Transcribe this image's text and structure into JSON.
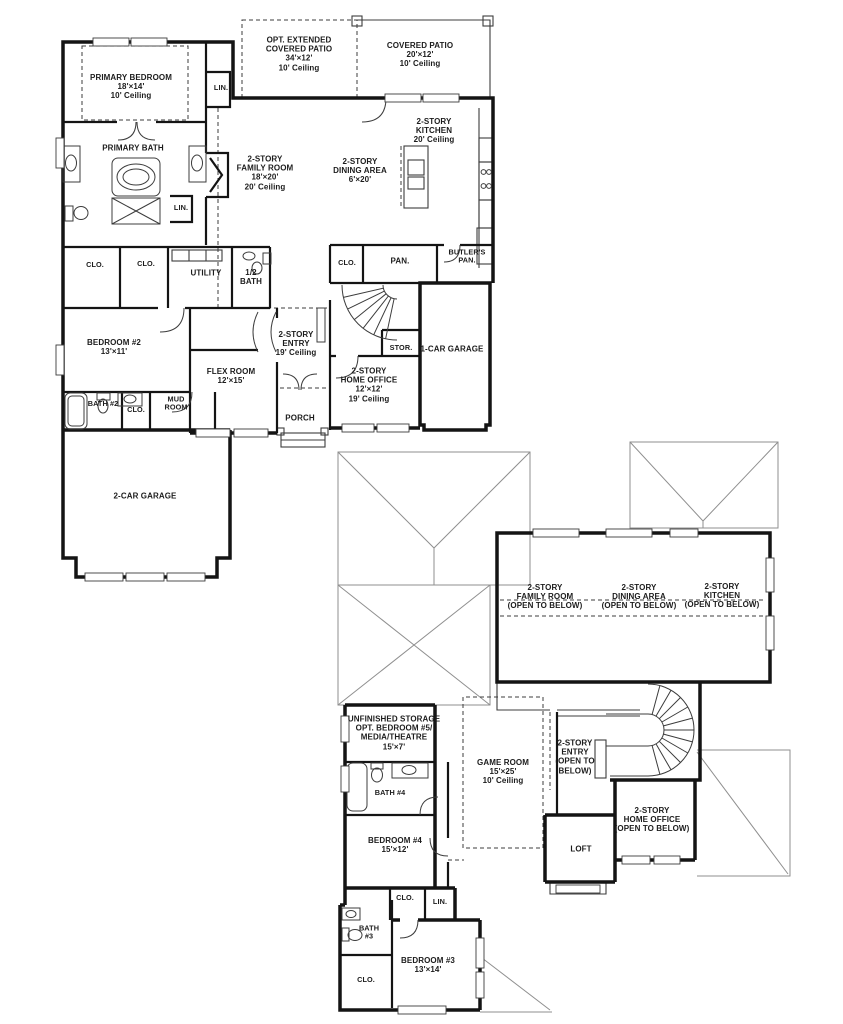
{
  "colors": {
    "background": "#ffffff",
    "walls": "#141414",
    "thin_lines": "#3c3c3c",
    "roof_lines": "#8f8f8f"
  },
  "fp": {
    "f1": {
      "primary_bedroom": [
        "PRIMARY BEDROOM",
        "18'×14'",
        "10' Ceiling"
      ],
      "opt_patio": [
        "OPT. EXTENDED",
        "COVERED PATIO",
        "34'×12'",
        "10' Ceiling"
      ],
      "covered_patio": [
        "COVERED PATIO",
        "20'×12'",
        "10' Ceiling"
      ],
      "lin_hall": [
        "LIN."
      ],
      "primary_bath": [
        "PRIMARY BATH"
      ],
      "family_room": [
        "2-STORY",
        "FAMILY ROOM",
        "18'×20'",
        "20' Ceiling"
      ],
      "dining_area": [
        "2-STORY",
        "DINING AREA",
        "6'×20'"
      ],
      "kitchen": [
        "2-STORY",
        "KITCHEN",
        "20' Ceiling"
      ],
      "lin_bath": [
        "LIN."
      ],
      "clo_1": [
        "CLO."
      ],
      "clo_2": [
        "CLO."
      ],
      "utility": [
        "UTILITY"
      ],
      "half_bath": [
        "1/2",
        "BATH"
      ],
      "clo_3": [
        "CLO."
      ],
      "pan": [
        "PAN."
      ],
      "butlers_pan": [
        "BUTLER'S",
        "PAN."
      ],
      "entry": [
        "2-STORY",
        "ENTRY",
        "19' Ceiling"
      ],
      "stor": [
        "STOR."
      ],
      "one_car_garage": [
        "1-CAR GARAGE"
      ],
      "bedroom_2": [
        "BEDROOM #2",
        "13'×11'"
      ],
      "flex_room": [
        "FLEX ROOM",
        "12'×15'"
      ],
      "home_office": [
        "2-STORY",
        "HOME OFFICE",
        "12'×12'",
        "19' Ceiling"
      ],
      "bath_2": [
        "BATH #2"
      ],
      "clo_4": [
        "CLO."
      ],
      "mud_room": [
        "MUD",
        "ROOM"
      ],
      "porch": [
        "PORCH"
      ],
      "two_car_garage": [
        "2-CAR GARAGE"
      ]
    },
    "f2": {
      "family_otb": [
        "2-STORY",
        "FAMILY ROOM",
        "(OPEN TO BELOW)"
      ],
      "dining_otb": [
        "2-STORY",
        "DINING AREA",
        "(OPEN TO BELOW)"
      ],
      "kitchen_otb": [
        "2-STORY",
        "KITCHEN",
        "(OPEN TO BELOW)"
      ],
      "storage": [
        "UNFINISHED STORAGE",
        "OPT. BEDROOM #5/",
        "MEDIA/THEATRE",
        "15'×7'"
      ],
      "game_room": [
        "GAME ROOM",
        "15'×25'",
        "10' Ceiling"
      ],
      "entry_otb": [
        "2-STORY",
        "ENTRY",
        "(OPEN TO",
        "BELOW)"
      ],
      "bath_4": [
        "BATH #4"
      ],
      "home_office_otb": [
        "2-STORY",
        "HOME OFFICE",
        "(OPEN TO BELOW)"
      ],
      "bedroom_4": [
        "BEDROOM #4",
        "15'×12'"
      ],
      "loft": [
        "LOFT"
      ],
      "clo_5": [
        "CLO."
      ],
      "lin_2": [
        "LIN."
      ],
      "bath_3": [
        "BATH",
        "#3"
      ],
      "bedroom_3": [
        "BEDROOM #3",
        "13'×14'"
      ],
      "clo_6": [
        "CLO."
      ]
    }
  }
}
